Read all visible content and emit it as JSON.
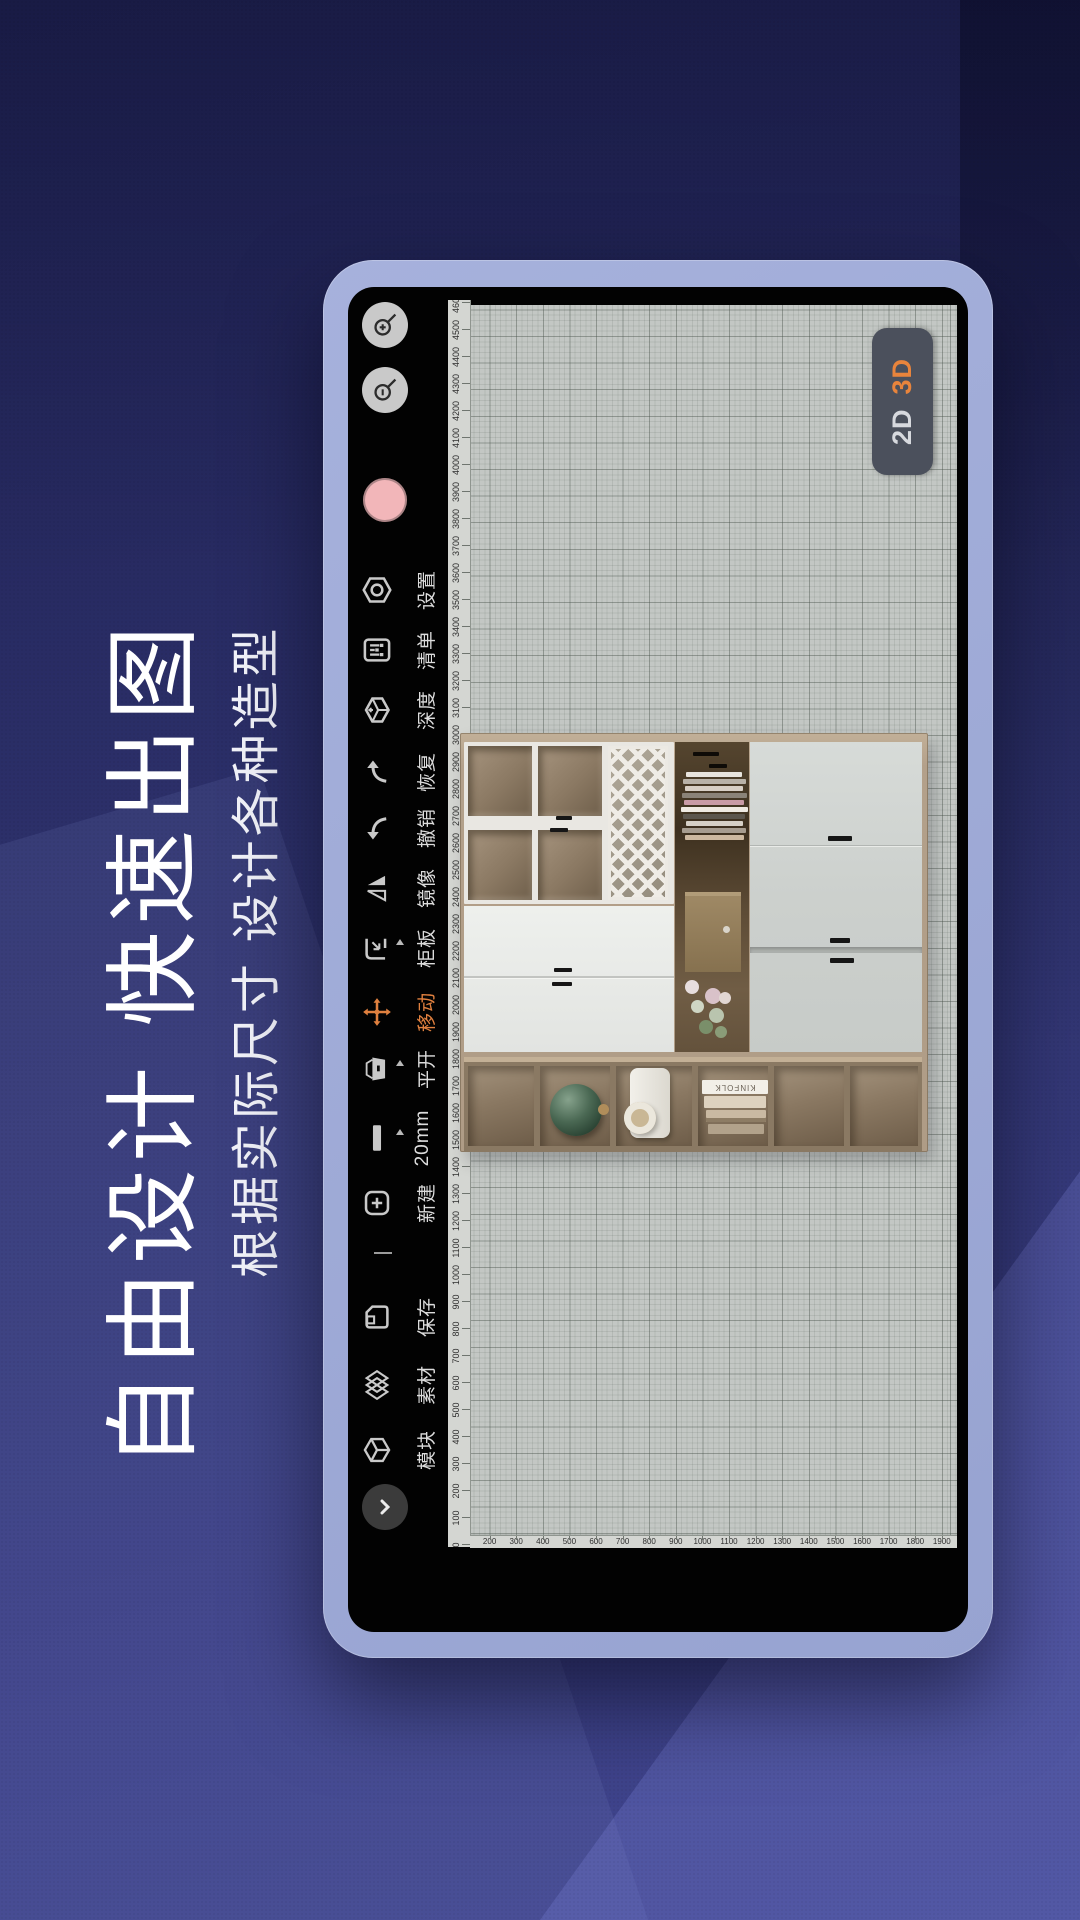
{
  "hero": {
    "title": "自由设计 快速出图",
    "subtitle": "根据实际尺寸 设计各种造型"
  },
  "view_toggle": {
    "options": [
      {
        "label": "2D",
        "active": false
      },
      {
        "label": "3D",
        "active": true
      }
    ]
  },
  "toolbar": {
    "items": [
      {
        "name": "collapse",
        "icon": "chevron-down-icon",
        "label": "",
        "type": "button"
      },
      {
        "name": "module",
        "icon": "cube-icon",
        "label": "模块"
      },
      {
        "name": "material",
        "icon": "layers-icon",
        "label": "素材"
      },
      {
        "name": "save",
        "icon": "floppy-icon",
        "label": "保存"
      },
      {
        "name": "divider",
        "type": "divider"
      },
      {
        "name": "new",
        "icon": "plus-square-icon",
        "label": "新建"
      },
      {
        "name": "thickness",
        "icon": "board-icon",
        "label": "20mm",
        "marker": true
      },
      {
        "name": "swing-door",
        "icon": "door-icon",
        "label": "平开",
        "marker": true
      },
      {
        "name": "move",
        "icon": "move-icon",
        "label": "移动",
        "active": true
      },
      {
        "name": "panel",
        "icon": "panel-icon",
        "label": "柜板",
        "marker": true
      },
      {
        "name": "mirror",
        "icon": "mirror-icon",
        "label": "镜像"
      },
      {
        "name": "undo",
        "icon": "undo-icon",
        "label": "撤销"
      },
      {
        "name": "redo",
        "icon": "redo-icon",
        "label": "恢复"
      },
      {
        "name": "depth",
        "icon": "depth-icon",
        "label": "深度"
      },
      {
        "name": "list",
        "icon": "list-icon",
        "label": "清单"
      },
      {
        "name": "settings",
        "icon": "settings-icon",
        "label": "设置"
      }
    ],
    "color_swatch": "#f2b6b9",
    "zoom_in_label": "+",
    "zoom_out_label": "−"
  },
  "rulers": {
    "wall_mm": {
      "min": 0,
      "max": 4600,
      "step": 100
    },
    "height_mm": {
      "min": 100,
      "max": 1900,
      "step": 100
    }
  },
  "cabinet": {
    "book_title": "KINFOLK"
  },
  "colors": {
    "accent_orange": "#e0803f",
    "swatch_pink": "#f2b6b9",
    "bezel": "#9ea9d5",
    "canvas_bg": "#c3c7c4",
    "toolbar_icon": "#c9c9c9",
    "wall_blue": "#2e326d"
  }
}
